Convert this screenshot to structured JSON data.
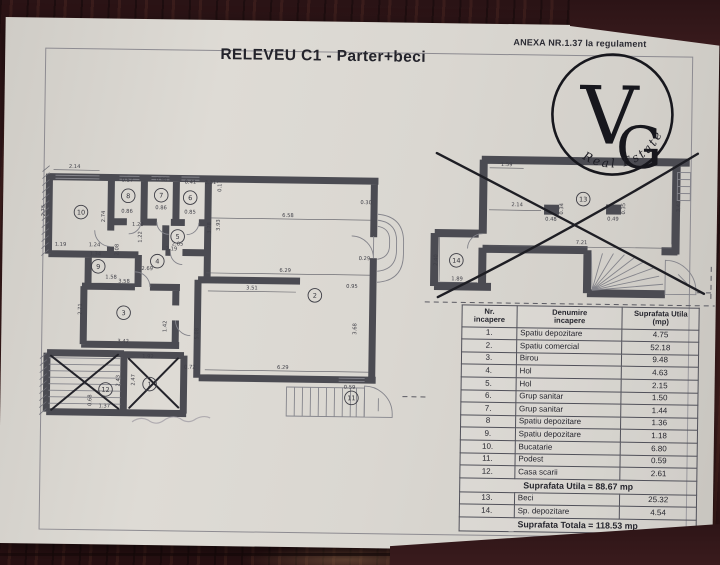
{
  "document": {
    "title": "RELEVEU C1 - Parter+beci",
    "annex": "ANEXA NR.1.37 la regulament"
  },
  "logo": {
    "letter_v": "V",
    "letter_g": "G",
    "arc_text": "Real Estate"
  },
  "table": {
    "headers": [
      [
        "Nr.",
        "incapere"
      ],
      [
        "Denumire",
        "incapere"
      ],
      [
        "Suprafata Utila",
        "(mp)"
      ]
    ],
    "rows": [
      [
        "1.",
        "Spatiu depozitare",
        "4.75"
      ],
      [
        "2.",
        "Spatiu comercial",
        "52.18"
      ],
      [
        "3.",
        "Birou",
        "9.48"
      ],
      [
        "4.",
        "Hol",
        "4.63"
      ],
      [
        "5.",
        "Hol",
        "2.15"
      ],
      [
        "6.",
        "Grup sanitar",
        "1.50"
      ],
      [
        "7.",
        "Grup sanitar",
        "1.44"
      ],
      [
        "8",
        "Spatiu depozitare",
        "1.36"
      ],
      [
        "9.",
        "Spatiu depozitare",
        "1.18"
      ],
      [
        "10.",
        "Bucatarie",
        "6.80"
      ],
      [
        "11.",
        "Podest",
        "0.59"
      ],
      [
        "12.",
        "Casa scarii",
        "2.61"
      ]
    ],
    "subtotal": "Suprafata Utila = 88.67 mp",
    "basement_rows": [
      [
        "13.",
        "Beci",
        "25.32"
      ],
      [
        "14.",
        "Sp. depozitare",
        "4.54"
      ]
    ],
    "total": "Suprafata Totala = 118.53 mp"
  },
  "floor_plan": {
    "rooms": [
      {
        "n": "10",
        "x": 40,
        "y": 58
      },
      {
        "n": "8",
        "x": 87,
        "y": 41
      },
      {
        "n": "7",
        "x": 120,
        "y": 40
      },
      {
        "n": "6",
        "x": 149,
        "y": 42
      },
      {
        "n": "5",
        "x": 137,
        "y": 81
      },
      {
        "n": "4",
        "x": 117,
        "y": 106
      },
      {
        "n": "9",
        "x": 58,
        "y": 112
      },
      {
        "n": "3",
        "x": 84,
        "y": 158
      },
      {
        "n": "12",
        "x": 67,
        "y": 235
      },
      {
        "n": "1",
        "x": 111,
        "y": 229
      },
      {
        "n": "2",
        "x": 275,
        "y": 138
      },
      {
        "n": "11",
        "x": 313,
        "y": 240
      }
    ],
    "dims": [
      {
        "t": "2.14",
        "x": 33,
        "y": 14
      },
      {
        "t": "2.75",
        "x": 4,
        "y": 57,
        "r": 1
      },
      {
        "t": "2.74",
        "x": 64,
        "y": 62,
        "r": 1
      },
      {
        "t": "1.19",
        "x": 20,
        "y": 92
      },
      {
        "t": "0.57",
        "x": 86,
        "y": 27
      },
      {
        "t": "0.98",
        "x": 120,
        "y": 26
      },
      {
        "t": "0.41",
        "x": 149,
        "y": 28
      },
      {
        "t": "3.31",
        "x": 169,
        "y": 28
      },
      {
        "t": "0.17",
        "x": 180,
        "y": 30,
        "r": 1
      },
      {
        "t": "0.86",
        "x": 86,
        "y": 58
      },
      {
        "t": "0.86",
        "x": 120,
        "y": 54
      },
      {
        "t": "0.85",
        "x": 149,
        "y": 58
      },
      {
        "t": "1.20",
        "x": 97,
        "y": 71
      },
      {
        "t": "1.22",
        "x": 101,
        "y": 82,
        "r": 1
      },
      {
        "t": "2.08",
        "x": 78,
        "y": 95,
        "r": 1
      },
      {
        "t": "2.05",
        "x": 137,
        "y": 90
      },
      {
        "t": "1.24",
        "x": 54,
        "y": 92
      },
      {
        "t": "1.34",
        "x": 55,
        "y": 101
      },
      {
        "t": "1.58",
        "x": 71,
        "y": 124
      },
      {
        "t": "2.19",
        "x": 131,
        "y": 95
      },
      {
        "t": "2.69",
        "x": 107,
        "y": 115
      },
      {
        "t": "3.78",
        "x": 170,
        "y": 72,
        "r": 1
      },
      {
        "t": "3.93",
        "x": 179,
        "y": 69,
        "r": 1
      },
      {
        "t": "6.58",
        "x": 247,
        "y": 60
      },
      {
        "t": "6.29",
        "x": 245,
        "y": 115
      },
      {
        "t": "3.51",
        "x": 212,
        "y": 133
      },
      {
        "t": "0.30",
        "x": 325,
        "y": 46
      },
      {
        "t": "0.29",
        "x": 324,
        "y": 102
      },
      {
        "t": "0.95",
        "x": 312,
        "y": 130
      },
      {
        "t": "3.68",
        "x": 317,
        "y": 171,
        "r": 1
      },
      {
        "t": "6.29",
        "x": 244,
        "y": 212
      },
      {
        "t": "5.08",
        "x": 159,
        "y": 178,
        "r": 1
      },
      {
        "t": "0.72",
        "x": 151,
        "y": 213
      },
      {
        "t": "3.58",
        "x": 84,
        "y": 128
      },
      {
        "t": "2.71",
        "x": 42,
        "y": 155,
        "r": 1
      },
      {
        "t": "3.42",
        "x": 84,
        "y": 188
      },
      {
        "t": "1.42",
        "x": 127,
        "y": 171,
        "r": 1
      },
      {
        "t": "1.92",
        "x": 109,
        "y": 203
      },
      {
        "t": "2.47",
        "x": 96,
        "y": 225,
        "r": 1
      },
      {
        "t": "2.43",
        "x": 81,
        "y": 226,
        "r": 1
      },
      {
        "t": "1.37",
        "x": 66,
        "y": 253
      },
      {
        "t": "0.68",
        "x": 53,
        "y": 246,
        "r": 1
      },
      {
        "t": "0.59",
        "x": 311,
        "y": 231
      }
    ]
  },
  "basement_plan": {
    "rooms": [
      {
        "n": "13",
        "x": 157,
        "y": 56
      },
      {
        "n": "14",
        "x": 31,
        "y": 119
      }
    ],
    "dims": [
      {
        "t": "1.59",
        "x": 80,
        "y": 24
      },
      {
        "t": "2.14",
        "x": 91,
        "y": 64
      },
      {
        "t": "0.48",
        "x": 125,
        "y": 78
      },
      {
        "t": "0.34",
        "x": 137,
        "y": 66,
        "r": 1
      },
      {
        "t": "0.49",
        "x": 187,
        "y": 77
      },
      {
        "t": "0.35",
        "x": 199,
        "y": 65,
        "r": 1
      },
      {
        "t": "7.21",
        "x": 156,
        "y": 101
      },
      {
        "t": "3.42",
        "x": 254,
        "y": 62,
        "r": 1
      },
      {
        "t": "2.40",
        "x": 12,
        "y": 119,
        "r": 1
      },
      {
        "t": "1.89",
        "x": 32,
        "y": 139
      }
    ]
  }
}
